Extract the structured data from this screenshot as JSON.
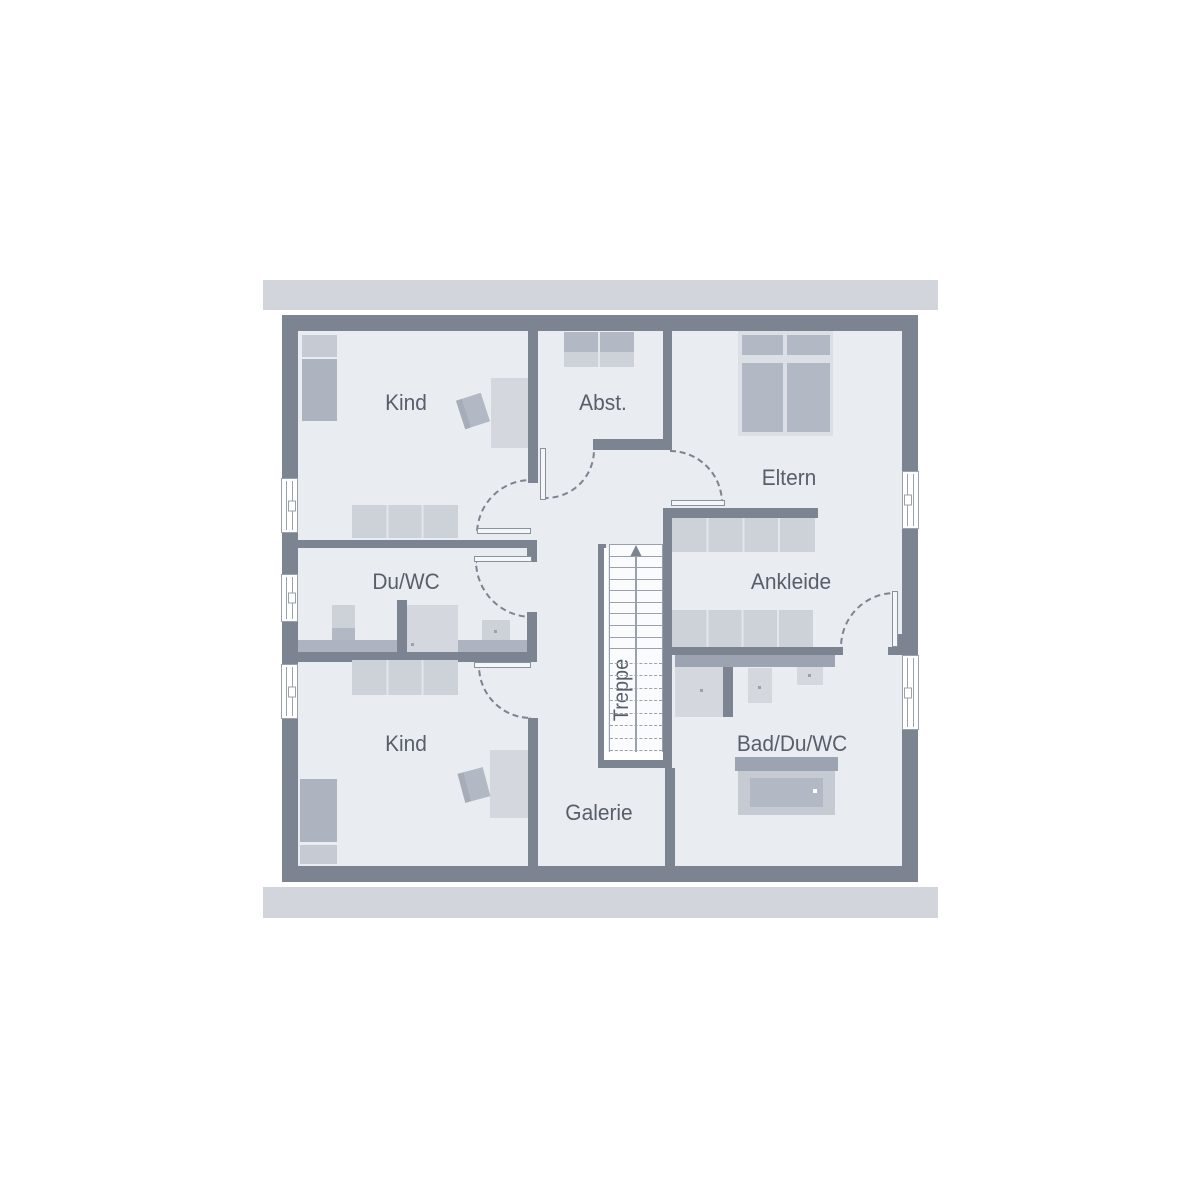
{
  "plan": {
    "rooms": [
      {
        "id": "kind-1",
        "label": "Kind"
      },
      {
        "id": "abstellraum",
        "label": "Abst."
      },
      {
        "id": "eltern",
        "label": "Eltern"
      },
      {
        "id": "du-wc",
        "label": "Du/WC"
      },
      {
        "id": "ankleide",
        "label": "Ankleide"
      },
      {
        "id": "treppe",
        "label": "Treppe"
      },
      {
        "id": "kind-2",
        "label": "Kind"
      },
      {
        "id": "galerie",
        "label": "Galerie"
      },
      {
        "id": "bad-du-wc",
        "label": "Bad/Du/WC"
      }
    ]
  },
  "colors": {
    "wall": "#7b8490",
    "floor": "#e9ecf1",
    "roof_band": "#d3d5dd",
    "furn_light": "#cdd2d9",
    "furn_medium": "#aeb4bf",
    "furn_pale": "#d4d8de",
    "furn_base": "#dcdfe5",
    "pillow": "#c5cad3",
    "mattress": "#b3b9c4",
    "counter": "#9ba4b0",
    "line": "#99a1ad",
    "seam": "#e3e6eb",
    "arc": "#7b8490",
    "stair_bg": "#fafbfd",
    "label_text": "#585f6a"
  }
}
